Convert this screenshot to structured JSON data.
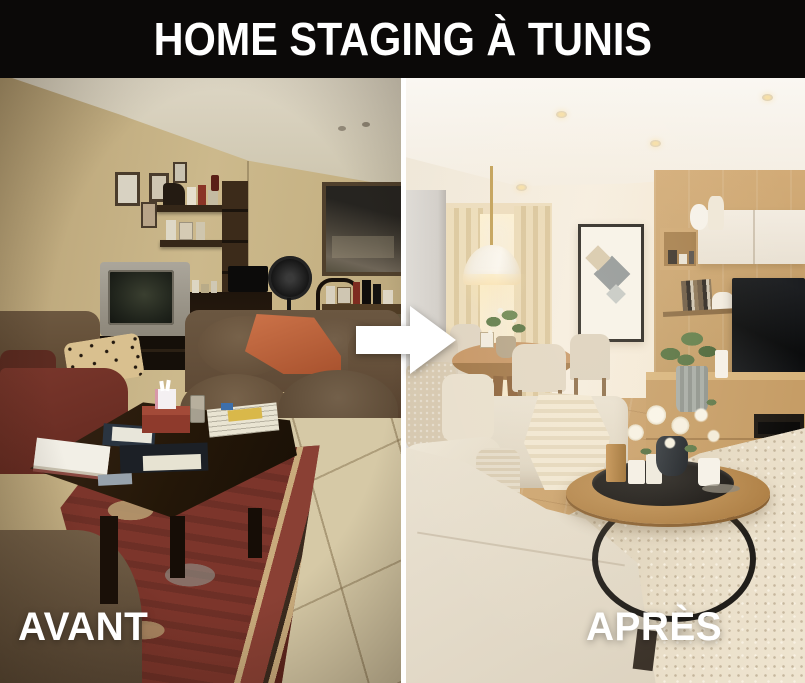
{
  "header": {
    "title": "HOME STAGING À TUNIS"
  },
  "before": {
    "label": "AVANT",
    "description": "Cluttered living room before staging: brown fabric sofas with leopard pillow and orange throw, CRT television on dark stand, wall shelves full of objects, standing fan, dark wood coffee table covered with books and papers, red oriental rug on beige tile floor"
  },
  "after": {
    "label": "APRÈS",
    "description": "Bright staged living room after: beige sectional sofa with knit throw, round wood coffee table with black tray, candles and white flower bouquet, light wood TV wall unit with white cabinets, green plants, dining corner with pendant lamp, beige curtains and abstract framed art, cream shag rug"
  },
  "arrow": {
    "icon": "arrow-right-icon",
    "color": "#ffffff"
  },
  "style": {
    "header_bg": "#0b0908",
    "label_color": "#ffffff",
    "divider_color": "#ffffff"
  }
}
